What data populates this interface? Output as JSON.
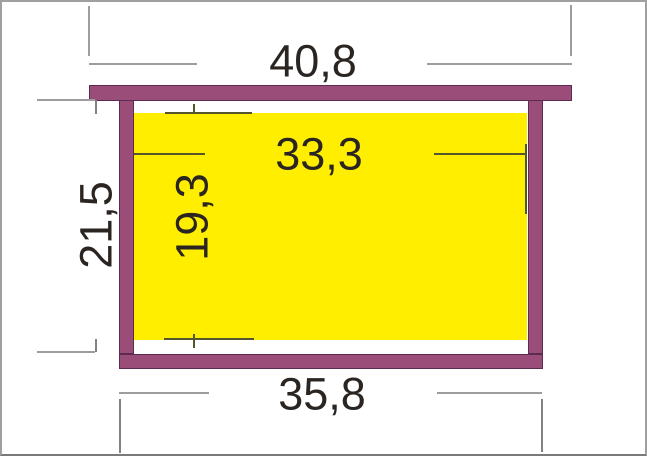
{
  "diagram": {
    "labels": {
      "top_bar_width": "40,8",
      "inner_width": "33,3",
      "side_height": "21,5",
      "comb_height": "19,3",
      "bottom_bar_width": "35,8"
    },
    "colors": {
      "frame": "#9a4d79",
      "frame_border": "#5d2b50",
      "comb": "#ffee00",
      "dim_line_outer": "#9d9d9d",
      "dim_line_inner": "#55552b",
      "dim_ext": "#828282",
      "label_text": "#2b2522",
      "page_border": "#a0a0a0"
    }
  }
}
